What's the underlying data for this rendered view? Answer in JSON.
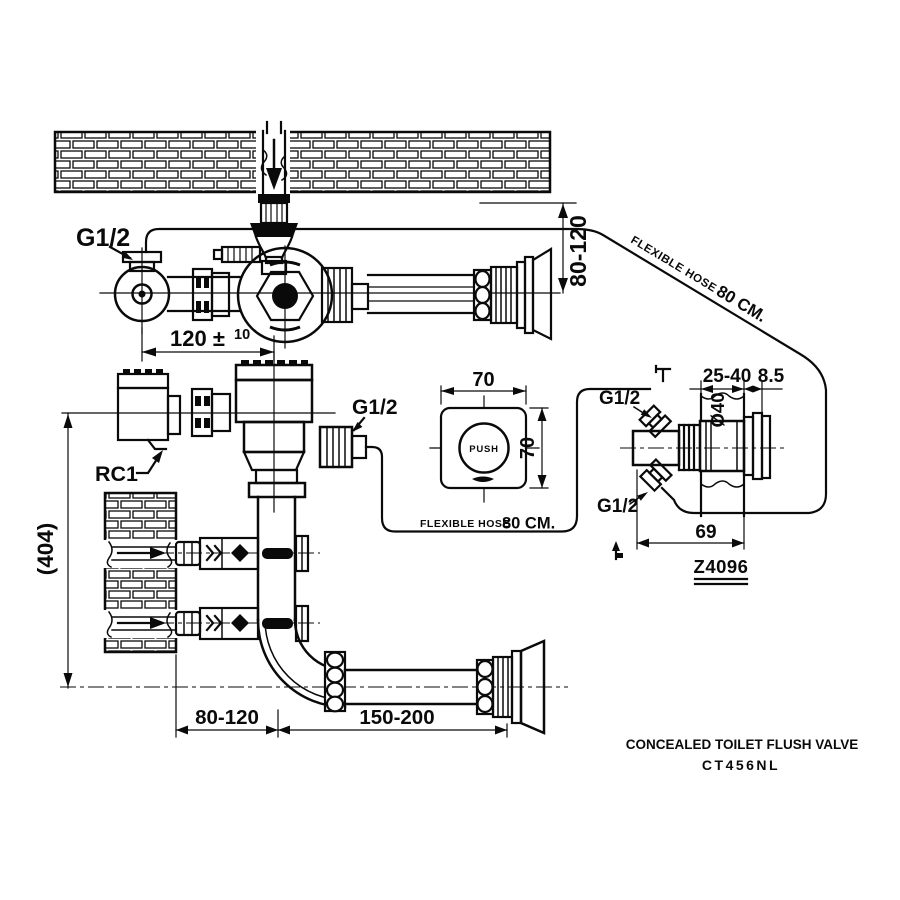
{
  "drawing": {
    "product_title": "CONCEALED TOILET FLUSH VALVE",
    "product_code": "CT456NL",
    "labels": {
      "supply_thread": "G1/2",
      "valve_outlet_thread": "G1/2",
      "inlet_top_thread": "G1/2",
      "inlet_bottom_thread": "G1/2",
      "stop_valve_code": "RC1",
      "push_button": "PUSH",
      "spud_code": "Z4096",
      "hose_diagonal_name": "FLEXIBLE HOSE",
      "hose_diagonal_length": "80 CM.",
      "hose_bottom_name": "FLEXIBLE HOSE",
      "hose_bottom_length": "80 CM."
    },
    "dimensions": {
      "wall_to_outlet": "80-120",
      "valve_spacing_main": "120 ±",
      "valve_spacing_tolerance": "10",
      "overall_height": "(404)",
      "plate_width": "70",
      "plate_height": "70",
      "wall_thickness_range": "25-40",
      "flange_lip": "8.5",
      "sleeve_diameter": "Ø40",
      "sleeve_depth": "69",
      "floor_offset": "80-120",
      "outlet_reach": "150-200"
    }
  }
}
